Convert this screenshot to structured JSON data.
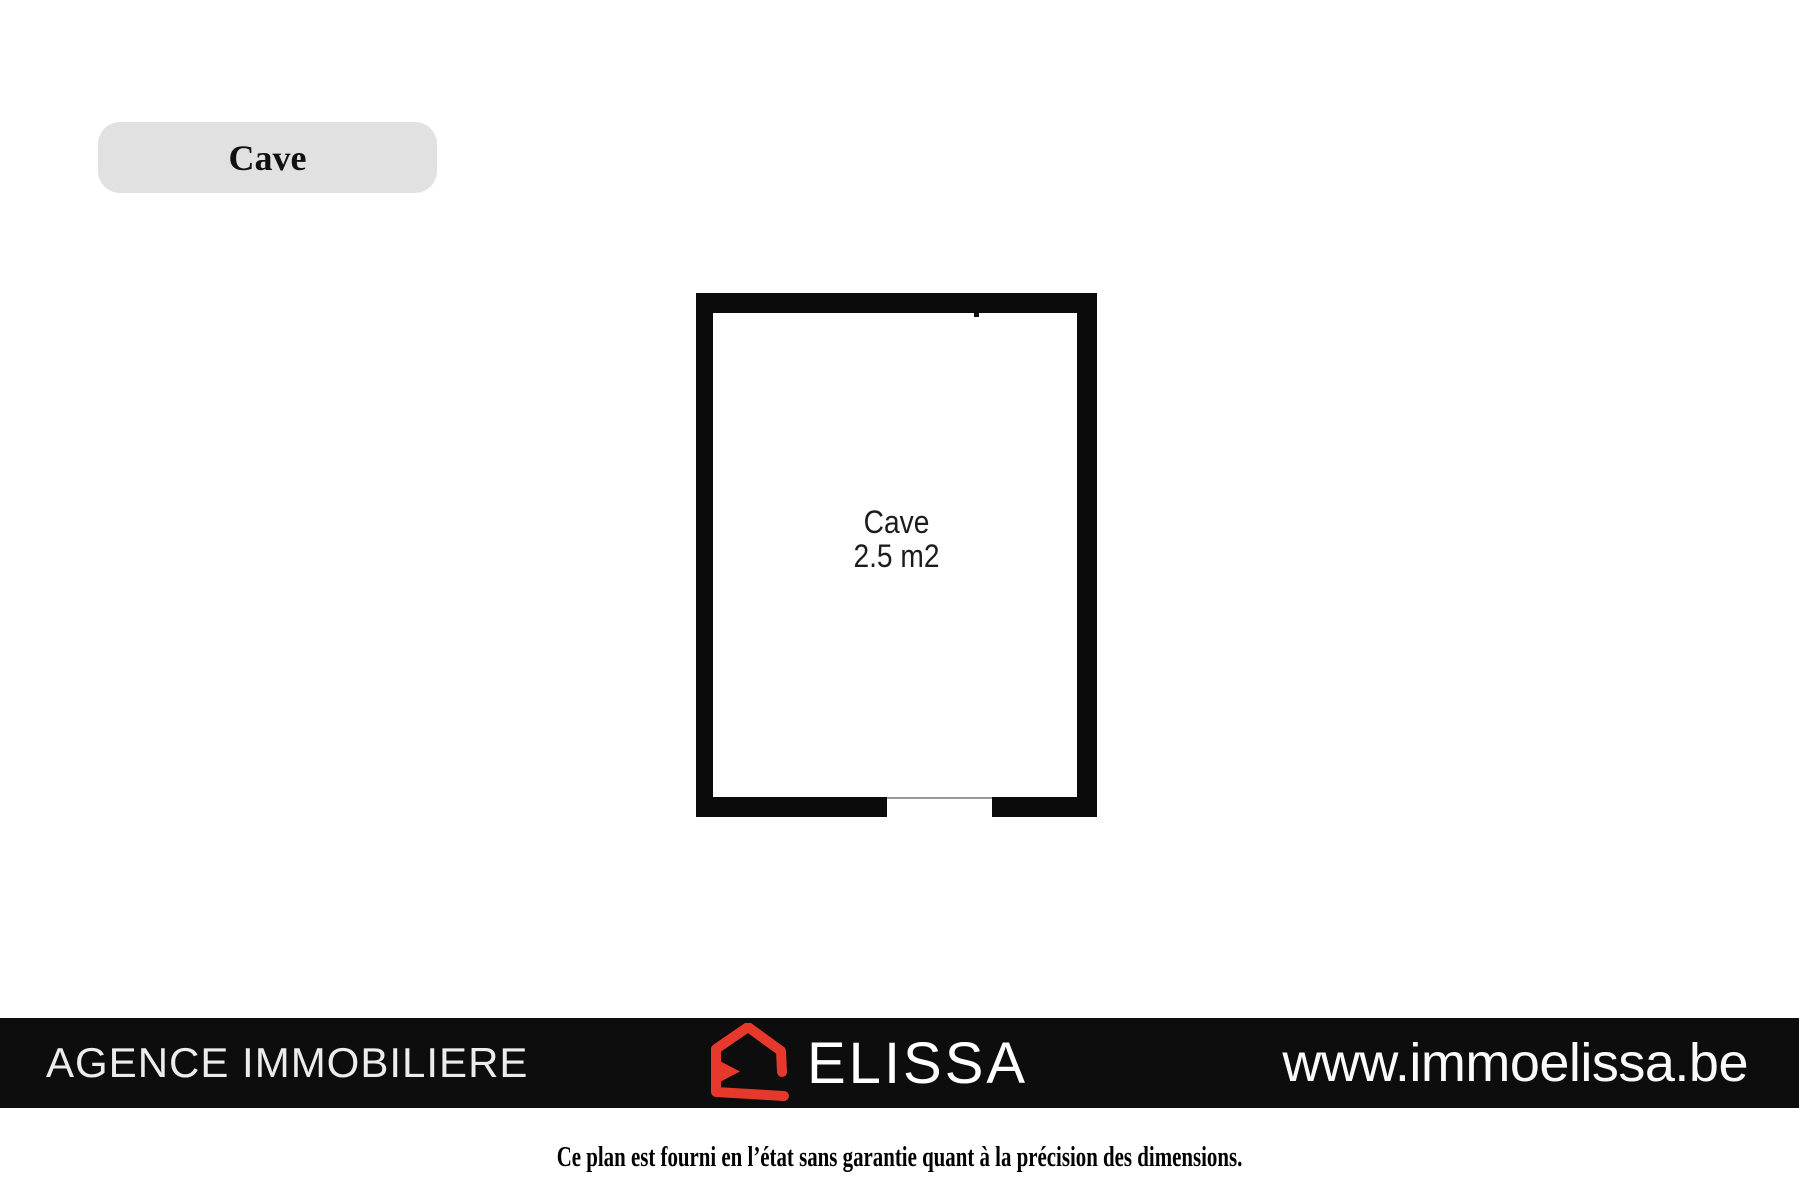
{
  "tab": {
    "label": "Cave"
  },
  "floorplan": {
    "room": {
      "name": "Cave",
      "area": "2.5 m2"
    },
    "wall_color": "#0b0b0b",
    "door_threshold_color": "#9a9a9a"
  },
  "footer": {
    "agency": "AGENCE IMMOBILIERE",
    "brand": "ELISSA",
    "website": "www.immoelissa.be",
    "bg_color": "#0d0d0d",
    "logo_red": "#e6392c",
    "text_color": "#fafafa"
  },
  "disclaimer": "Ce plan est fourni en l’état sans garantie quant à la précision des dimensions.",
  "colors": {
    "page_bg": "#ffffff",
    "tab_bg": "#e1e1e1"
  }
}
